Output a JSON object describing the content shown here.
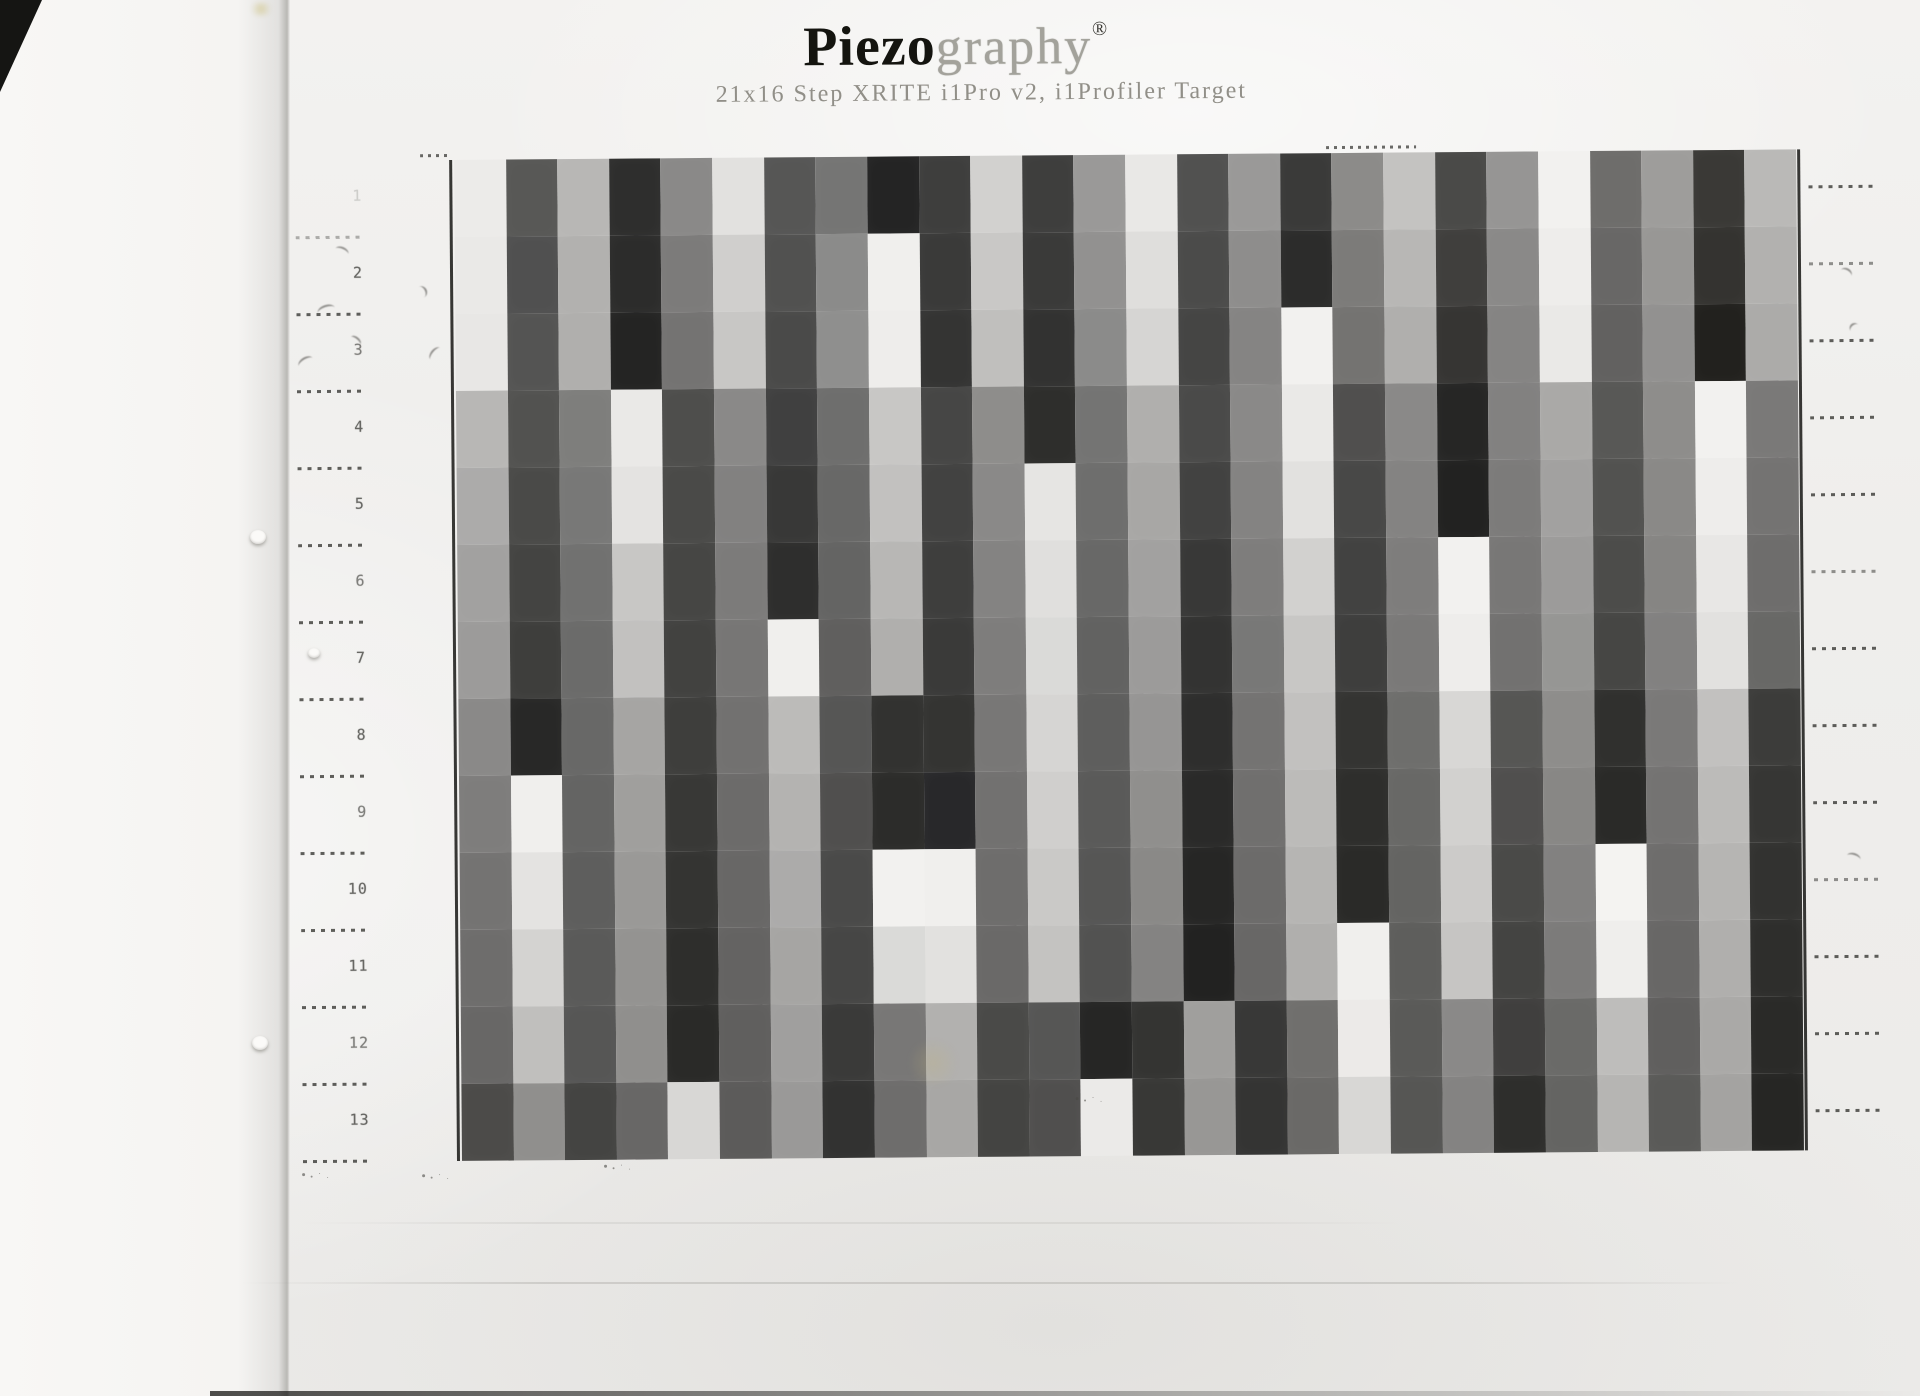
{
  "header": {
    "title_black": "Piezo",
    "title_light": "graphy",
    "registered": "®",
    "subtitle": "21x16 Step XRITE i1Pro v2, i1Profiler Target"
  },
  "page_colors": {
    "paper": "#f1f0ee",
    "border_line": "#1c1c1a",
    "ruler_ink": "#33332f"
  },
  "target": {
    "rows": 13,
    "cols": 26,
    "row_labels": [
      "1",
      "2",
      "3",
      "4",
      "5",
      "6",
      "7",
      "8",
      "9",
      "10",
      "11",
      "12",
      "13"
    ],
    "patches": [
      [
        "#ecebe9",
        "#585856",
        "#b8b7b5",
        "#2e2e2d",
        "#8a8988",
        "#e2e1df",
        "#565655",
        "#757574",
        "#242424",
        "#3e3e3d",
        "#d2d1cf",
        "#3e3e3d",
        "#9a9998",
        "#e9e8e6",
        "#515150",
        "#9a9998",
        "#3a3a39",
        "#8c8b89",
        "#c4c3c1",
        "#4a4a48",
        "#969594",
        "#f2f1ef",
        "#6e6d6b",
        "#9e9d9b",
        "#3a3936",
        "#bab9b7"
      ],
      [
        "#eae9e7",
        "#505050",
        "#b2b1af",
        "#2c2c2b",
        "#7c7b7a",
        "#d0cfcd",
        "#515150",
        "#8b8b8a",
        "#f0efed",
        "#3a3a39",
        "#c9c8c6",
        "#3a3a39",
        "#929190",
        "#dfdedc",
        "#4b4b4a",
        "#8e8d8c",
        "#2c2c2b",
        "#7c7b79",
        "#b8b7b5",
        "#403f3d",
        "#8a8988",
        "#eeedeb",
        "#686766",
        "#989795",
        "#343330",
        "#b2b1af"
      ],
      [
        "#e8e7e5",
        "#545453",
        "#b0afad",
        "#242423",
        "#747372",
        "#c8c7c5",
        "#4a4a49",
        "#8f8f8e",
        "#eeedeb",
        "#343433",
        "#c0bfbd",
        "#323231",
        "#8b8b8a",
        "#d6d5d3",
        "#454544",
        "#858483",
        "#f2f1ef",
        "#747371",
        "#b0afad",
        "#363533",
        "#858483",
        "#eae9e7",
        "#626160",
        "#929190",
        "#22211e",
        "#acaba9"
      ],
      [
        "#b8b7b5",
        "#525250",
        "#7e7e7c",
        "#eae9e7",
        "#4e4e4c",
        "#8a8988",
        "#404040",
        "#6e6e6d",
        "#c8c7c5",
        "#464645",
        "#8e8d8b",
        "#2e2e2c",
        "#747473",
        "#b0afad",
        "#4a4a49",
        "#8a8988",
        "#eae9e7",
        "#504f4e",
        "#8a8988",
        "#262625",
        "#828180",
        "#aaa9a7",
        "#585856",
        "#8e8d8b",
        "#f2f1ef",
        "#7a7978"
      ],
      [
        "#acabaa",
        "#4a4a48",
        "#787877",
        "#e4e3e1",
        "#4a4a48",
        "#828180",
        "#383837",
        "#686867",
        "#c2c1bf",
        "#424241",
        "#8a8988",
        "#e6e5e3",
        "#6e6e6d",
        "#a8a7a5",
        "#424241",
        "#848382",
        "#e2e1df",
        "#484847",
        "#848382",
        "#222221",
        "#7c7b7a",
        "#a2a1a0",
        "#525250",
        "#8a8987",
        "#eeedeb",
        "#747372"
      ],
      [
        "#a2a1a0",
        "#444442",
        "#717170",
        "#c8c7c5",
        "#464644",
        "#7c7b7a",
        "#2e2e2d",
        "#646463",
        "#b8b7b5",
        "#3e3e3d",
        "#848382",
        "#e0dfdd",
        "#686867",
        "#a2a1a0",
        "#383837",
        "#7e7d7c",
        "#d2d1cf",
        "#424241",
        "#7e7d7c",
        "#f2f1ef",
        "#787776",
        "#9c9b9a",
        "#4c4c4a",
        "#868583",
        "#e8e7e5",
        "#6e6d6c"
      ],
      [
        "#9c9b9a",
        "#3e3e3c",
        "#6b6b6a",
        "#c2c1bf",
        "#424240",
        "#777675",
        "#f0efed",
        "#605f5e",
        "#b0afad",
        "#3a3a39",
        "#7e7d7c",
        "#dadad8",
        "#626261",
        "#9c9b9a",
        "#333332",
        "#787877",
        "#c8c7c5",
        "#3e3e3d",
        "#7a7978",
        "#eeedeb",
        "#727170",
        "#969694",
        "#464644",
        "#828180",
        "#e2e1df",
        "#686866"
      ],
      [
        "#8a8988",
        "#282827",
        "#686867",
        "#a6a5a3",
        "#3e3e3c",
        "#727170",
        "#bcbbb9",
        "#565655",
        "#323230",
        "#343432",
        "#787776",
        "#d6d5d3",
        "#5e5e5d",
        "#969594",
        "#2e2e2d",
        "#747372",
        "#c2c1bf",
        "#343432",
        "#6e6e6c",
        "#d8d7d5",
        "#565654",
        "#8e8d8b",
        "#30302e",
        "#7a7978",
        "#c2c1bf",
        "#3c3c3a"
      ],
      [
        "#7e7d7c",
        "#f0efed",
        "#646463",
        "#a09f9d",
        "#383836",
        "#6c6b6a",
        "#b4b3b1",
        "#504f4e",
        "#2c2c2a",
        "#28282a",
        "#727170",
        "#d0cfcd",
        "#5a5a59",
        "#908f8d",
        "#2a2a29",
        "#706f6e",
        "#bcbbb9",
        "#2e2e2c",
        "#686866",
        "#d2d1cf",
        "#504f4e",
        "#888785",
        "#2a2a28",
        "#747372",
        "#bcbbb9",
        "#363634"
      ],
      [
        "#747372",
        "#e4e3e1",
        "#5e5e5d",
        "#9a9997",
        "#343432",
        "#686766",
        "#acabaa",
        "#4a4a49",
        "#f2f1ef",
        "#f0efed",
        "#6e6d6c",
        "#cac9c7",
        "#565655",
        "#8a8987",
        "#262625",
        "#6c6b6a",
        "#b6b5b3",
        "#2a2a28",
        "#646462",
        "#cccbc9",
        "#4a4a48",
        "#828180",
        "#f4f3f1",
        "#6e6d6c",
        "#b6b5b3",
        "#323230"
      ],
      [
        "#6e6d6c",
        "#d4d3d1",
        "#5a5a59",
        "#949391",
        "#2e2e2c",
        "#646362",
        "#a6a5a3",
        "#464645",
        "#dadad8",
        "#e2e1df",
        "#6a6968",
        "#c4c3c1",
        "#525251",
        "#848382",
        "#222221",
        "#686766",
        "#b0afad",
        "#f0efed",
        "#5e5e5c",
        "#c6c5c3",
        "#444442",
        "#7c7b7a",
        "#efeeec",
        "#686766",
        "#b0afad",
        "#2e2e2c"
      ],
      [
        "#686766",
        "#c0bfbd",
        "#565655",
        "#908f8d",
        "#2a2a28",
        "#605f5e",
        "#a09f9e",
        "#3a3a39",
        "#787776",
        "#b2b1af",
        "#4a4a48",
        "#565655",
        "#262625",
        "#343432",
        "#a09f9d",
        "#383837",
        "#706f6d",
        "#eceae8",
        "#5a5a58",
        "#8a8988",
        "#403f3e",
        "#6a6a68",
        "#bebdbb",
        "#605f5e",
        "#aaa9a7",
        "#2a2a28"
      ],
      [
        "#4c4b49",
        "#908f8d",
        "#444442",
        "#686766",
        "#d8d7d5",
        "#5c5b5a",
        "#9a9998",
        "#323231",
        "#6e6d6c",
        "#a8a7a5",
        "#444442",
        "#504f4e",
        "#ebeae8",
        "#383836",
        "#989795",
        "#343433",
        "#6a6967",
        "#d8d7d5",
        "#565654",
        "#848382",
        "#2e2e2c",
        "#646462",
        "#b6b5b3",
        "#5a5a58",
        "#a4a3a1",
        "#262624"
      ]
    ]
  }
}
